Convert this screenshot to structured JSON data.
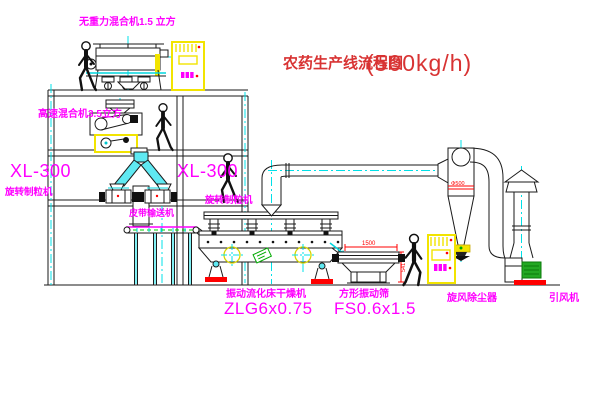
{
  "title": {
    "text": "农药生产线流程图",
    "capacity": "(500kg/h)"
  },
  "labels": {
    "gravity_mixer": "无重力混合机1.5 立方",
    "high_speed_mixer": "高速混合机3.5立方",
    "granulator_left_model": "XL-300",
    "granulator_left_name": "旋转制粒机",
    "granulator_right_model": "XL-300",
    "granulator_right_name": "旋转制粒机",
    "belt_conveyor": "皮带输送机",
    "dryer_name": "振动流化床干燥机",
    "dryer_model": "ZLG6x0.75",
    "sieve_name": "方形振动筛",
    "sieve_model": "FS0.6x1.5",
    "cyclone": "旋风除尘器",
    "fan": "引风机"
  },
  "dimensions": {
    "cyclone_diameter": "Φ500",
    "sieve_length": "1500",
    "sieve_height": "541"
  },
  "colors": {
    "label_magenta": "#FF00FF",
    "title_red": "#D83333",
    "dimension_red": "#FF0000",
    "centerline_cyan": "#00E0E8",
    "duct_fill_cyan": "#5FE9F2",
    "cabinet_yellow": "#FFFF00",
    "belt_green": "#00CC00",
    "fan_green": "#22A822",
    "line_black": "#1A1A1A"
  }
}
